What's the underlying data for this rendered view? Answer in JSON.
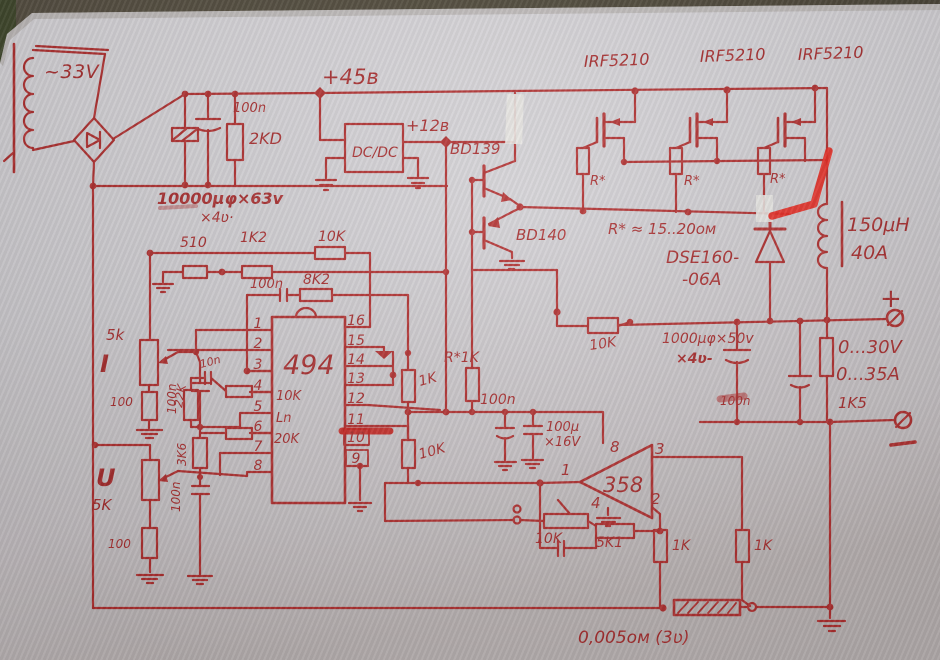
{
  "photo": {
    "description": "hand-drawn power supply schematic in red ink on grey paper"
  },
  "colors": {
    "ink": "#b23030",
    "marker": "#e8271e",
    "paper": "#d3d1d5"
  },
  "labels": {
    "trafo": "~33V",
    "rail45": "+45в",
    "irf1": "IRF5210",
    "irf2": "IRF5210",
    "irf3": "IRF5210",
    "c100n_top": "100n",
    "r2kd": "2KD",
    "bigcap": "10000μφ×63v",
    "bigcap_qty": "×4ʋ·",
    "dcdc": "DC/DC",
    "rail12": "+12в",
    "bd139": "BD139",
    "bd140": "BD140",
    "r510": "510",
    "r1k2": "1K2",
    "r10k_top": "10K",
    "c100n_fb": "100n",
    "r8k2": "8K2",
    "pot_i_val": "5k",
    "pot_i": "I",
    "r100_i": "100",
    "c100n_i": "100n",
    "r22k": "22K",
    "c10n": "10n",
    "r3k6": "3K6",
    "pot_u": "U",
    "pot_u_val": "5K",
    "c100n_u": "100n",
    "r100_u": "100",
    "r1k_col": "1K",
    "r1k_drv": "R*1K",
    "c100n_mid": "100n",
    "c100u": "100μ",
    "c100u_v": "×16V",
    "r10k_col": "10K",
    "r10k_sense": "10K",
    "rstar1": "R*",
    "rstar2": "R*",
    "rstar3": "R*",
    "rstar_note": "R* ≈ 15..20ом",
    "dse1": "DSE160-",
    "dse2": "-06A",
    "ind_l": "150μH",
    "ind_a": "40A",
    "cap1000": "1000μφ×50v",
    "cap1000_qty": "×4ʋ-",
    "out_v": "0...30V",
    "out_a": "0...35A",
    "r1k5": "1K5",
    "c100n_out": "100n",
    "plus": "+",
    "shunt": "0,005ом (3ʋ)",
    "r10k_fb": "10K",
    "r5k1": "5K1",
    "r1k_a": "1K",
    "r1k_b": "1K"
  },
  "ic494": {
    "name": "494",
    "note_10k": "10K",
    "note_ln": "Ln",
    "note_20k": "20K",
    "pins_left": [
      "1",
      "2",
      "3",
      "4",
      "5",
      "6",
      "7",
      "8"
    ],
    "pins_right": [
      "16",
      "15",
      "14",
      "13",
      "12",
      "11",
      "10",
      "9"
    ]
  },
  "op358": {
    "name": "358",
    "p1": "1",
    "p2": "2",
    "p3": "3",
    "p4": "4",
    "p8": "8"
  }
}
